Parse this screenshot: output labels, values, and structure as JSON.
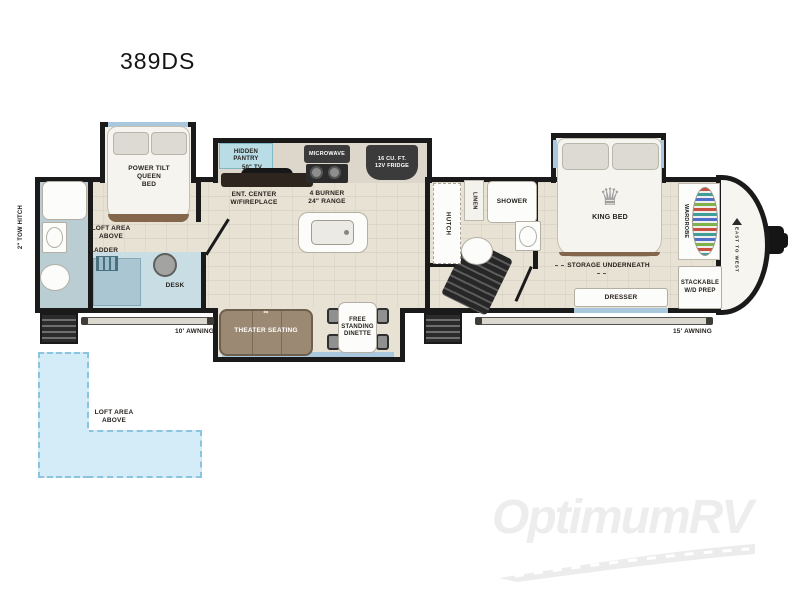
{
  "page": {
    "title": "389DS",
    "watermark": "OptimumRV"
  },
  "icons": {
    "crown": "♛",
    "cupholders": "∞"
  },
  "colors": {
    "wall": "#1a1a1a",
    "floor": "#e7e2d4",
    "bath_floor": "#bacdd2",
    "desk_floor": "#c9dde5",
    "window": "#a9c8de",
    "loft": "#d3ecf8",
    "theater": "#9c8974",
    "appliance": "#3b3b3b"
  },
  "floorplan": {
    "exterior": {
      "tow_hitch": "2\" TOW HITCH",
      "brand": "EAST TO WEST",
      "awning_left": "10' AWNING",
      "awning_right": "15' AWNING"
    },
    "front_left": {
      "bed": "POWER TILT\nQUEEN\nBED",
      "loft": "LOFT AREA\nABOVE",
      "ladder": "LADDER",
      "desk": "DESK"
    },
    "kitchen": {
      "pantry": "HIDDEN\nPANTRY",
      "tv": "50\" TV",
      "ent_center": "ENT. CENTER\nW/FIREPLACE",
      "microwave": "MICROWAVE",
      "range": "4 BURNER\n24\" RANGE",
      "fridge": "16 CU. FT.\n12V FRIDGE"
    },
    "living": {
      "theater": "THEATER SEATING",
      "dinette": "FREE\nSTANDING\nDINETTE"
    },
    "mid_bath": {
      "hutch": "HUTCH",
      "linen": "LINEN",
      "shower": "SHOWER"
    },
    "bedroom": {
      "king_bed": "KING BED",
      "storage": "STORAGE UNDERNEATH",
      "dresser": "DRESSER",
      "wardrobe": "WARDROBE",
      "stackable": "STACKABLE\nW/D PREP"
    },
    "loft_zone": {
      "label": "LOFT AREA\nABOVE"
    }
  }
}
